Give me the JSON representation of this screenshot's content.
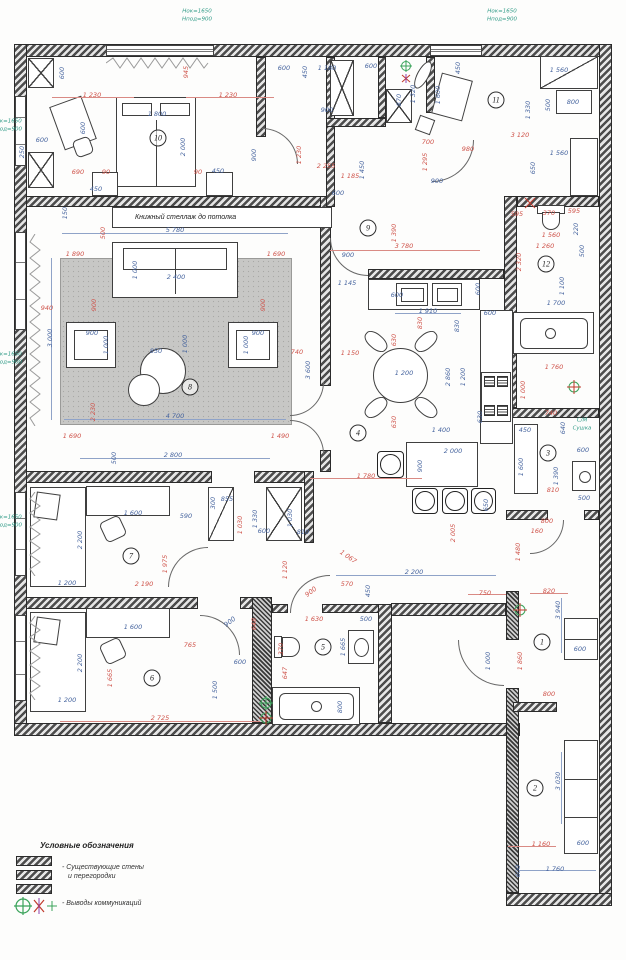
{
  "texts": {
    "bookshelf": "Книжный стеллаж до потолка",
    "laundry_1": "С/М",
    "laundry_2": "Сушка"
  },
  "legend": {
    "title": "Условные обозначения",
    "walls_label_1": "- Существующие стены",
    "walls_label_2": "и перегородки",
    "comm_label": "- Выводы коммуникаций"
  },
  "colors": {
    "dim_red": "#cf544b",
    "dim_blue": "#47659f",
    "annot_green": "#2f9a86",
    "wall": "#4c4c4c"
  },
  "rooms": [
    {
      "n": "10",
      "x": 158,
      "y": 138
    },
    {
      "n": "11",
      "x": 496,
      "y": 100
    },
    {
      "n": "9",
      "x": 368,
      "y": 228
    },
    {
      "n": "12",
      "x": 546,
      "y": 264
    },
    {
      "n": "8",
      "x": 190,
      "y": 387
    },
    {
      "n": "4",
      "x": 358,
      "y": 433
    },
    {
      "n": "3",
      "x": 548,
      "y": 453
    },
    {
      "n": "7",
      "x": 131,
      "y": 556
    },
    {
      "n": "5",
      "x": 323,
      "y": 647
    },
    {
      "n": "6",
      "x": 152,
      "y": 678
    },
    {
      "n": "1",
      "x": 542,
      "y": 642
    },
    {
      "n": "2",
      "x": 535,
      "y": 788
    }
  ],
  "dims": [
    {
      "t": "Hок=1650",
      "x": 197,
      "y": 12,
      "c": "g"
    },
    {
      "t": "Hпод=900",
      "x": 197,
      "y": 20,
      "c": "g"
    },
    {
      "t": "Hок=1650",
      "x": 502,
      "y": 12,
      "c": "g"
    },
    {
      "t": "Hпод=900",
      "x": 502,
      "y": 20,
      "c": "g"
    },
    {
      "t": "Hок=1650",
      "x": 7,
      "y": 122,
      "c": "g"
    },
    {
      "t": "Hпод=900",
      "x": 7,
      "y": 130,
      "c": "g"
    },
    {
      "t": "Hок=1650",
      "x": 7,
      "y": 355,
      "c": "g"
    },
    {
      "t": "Hпод=900",
      "x": 7,
      "y": 363,
      "c": "g"
    },
    {
      "t": "Hок=1650",
      "x": 7,
      "y": 518,
      "c": "g"
    },
    {
      "t": "Hпод=900",
      "x": 7,
      "y": 526,
      "c": "g"
    },
    {
      "t": "С/М",
      "x": 582,
      "y": 421,
      "c": "g"
    },
    {
      "t": "Сушка",
      "x": 582,
      "y": 429,
      "c": "g"
    },
    {
      "t": "1 230",
      "x": 92,
      "y": 95,
      "c": "r"
    },
    {
      "t": "1 230",
      "x": 228,
      "y": 95,
      "c": "r"
    },
    {
      "t": "1 800",
      "x": 157,
      "y": 114,
      "c": "b"
    },
    {
      "t": "2 000",
      "x": 183,
      "y": 147,
      "c": "b",
      "v": 1
    },
    {
      "t": "945",
      "x": 186,
      "y": 72,
      "c": "r",
      "v": 1
    },
    {
      "t": "600",
      "x": 62,
      "y": 73,
      "c": "b",
      "v": 1
    },
    {
      "t": "600",
      "x": 42,
      "y": 140,
      "c": "b"
    },
    {
      "t": "250",
      "x": 22,
      "y": 152,
      "c": "b",
      "v": 1
    },
    {
      "t": "600",
      "x": 83,
      "y": 128,
      "c": "b",
      "v": 1
    },
    {
      "t": "690",
      "x": 78,
      "y": 172,
      "c": "r"
    },
    {
      "t": "90",
      "x": 106,
      "y": 172,
      "c": "r"
    },
    {
      "t": "90",
      "x": 198,
      "y": 172,
      "c": "r"
    },
    {
      "t": "450",
      "x": 96,
      "y": 189,
      "c": "b"
    },
    {
      "t": "450",
      "x": 218,
      "y": 171,
      "c": "b"
    },
    {
      "t": "900",
      "x": 254,
      "y": 155,
      "c": "b",
      "v": 1
    },
    {
      "t": "1 230",
      "x": 299,
      "y": 155,
      "c": "r",
      "v": 1
    },
    {
      "t": "600",
      "x": 284,
      "y": 68,
      "c": "b"
    },
    {
      "t": "450",
      "x": 305,
      "y": 72,
      "c": "b",
      "v": 1
    },
    {
      "t": "1 180",
      "x": 327,
      "y": 68,
      "c": "b"
    },
    {
      "t": "600",
      "x": 371,
      "y": 66,
      "c": "b"
    },
    {
      "t": "450",
      "x": 458,
      "y": 68,
      "c": "b",
      "v": 1
    },
    {
      "t": "1 320",
      "x": 413,
      "y": 94,
      "c": "b",
      "v": 1
    },
    {
      "t": "870",
      "x": 399,
      "y": 100,
      "c": "b",
      "v": 1
    },
    {
      "t": "900",
      "x": 327,
      "y": 110,
      "c": "b"
    },
    {
      "t": "1 600",
      "x": 438,
      "y": 95,
      "c": "b",
      "v": 1
    },
    {
      "t": "1 330",
      "x": 528,
      "y": 110,
      "c": "b",
      "v": 1
    },
    {
      "t": "500",
      "x": 548,
      "y": 105,
      "c": "b",
      "v": 1
    },
    {
      "t": "800",
      "x": 573,
      "y": 102,
      "c": "b"
    },
    {
      "t": "1 560",
      "x": 559,
      "y": 70,
      "c": "b"
    },
    {
      "t": "3 120",
      "x": 520,
      "y": 135,
      "c": "r"
    },
    {
      "t": "980",
      "x": 468,
      "y": 149,
      "c": "r"
    },
    {
      "t": "700",
      "x": 428,
      "y": 142,
      "c": "r"
    },
    {
      "t": "900",
      "x": 437,
      "y": 181,
      "c": "b"
    },
    {
      "t": "1 560",
      "x": 559,
      "y": 153,
      "c": "b"
    },
    {
      "t": "650",
      "x": 533,
      "y": 168,
      "c": "b",
      "v": 1
    },
    {
      "t": "1 450",
      "x": 362,
      "y": 170,
      "c": "b",
      "v": 1
    },
    {
      "t": "1 295",
      "x": 425,
      "y": 162,
      "c": "r",
      "v": 1
    },
    {
      "t": "2 255",
      "x": 326,
      "y": 166,
      "c": "r"
    },
    {
      "t": "1 185",
      "x": 350,
      "y": 176,
      "c": "r"
    },
    {
      "t": "600",
      "x": 338,
      "y": 193,
      "c": "b"
    },
    {
      "t": "1 390",
      "x": 394,
      "y": 233,
      "c": "r",
      "v": 1
    },
    {
      "t": "595",
      "x": 517,
      "y": 214,
      "c": "r"
    },
    {
      "t": "370",
      "x": 549,
      "y": 213,
      "c": "r"
    },
    {
      "t": "595",
      "x": 574,
      "y": 211,
      "c": "r"
    },
    {
      "t": "220",
      "x": 576,
      "y": 229,
      "c": "b",
      "v": 1
    },
    {
      "t": "1 560",
      "x": 551,
      "y": 235,
      "c": "r"
    },
    {
      "t": "1 260",
      "x": 545,
      "y": 246,
      "c": "r"
    },
    {
      "t": "500",
      "x": 582,
      "y": 251,
      "c": "b",
      "v": 1
    },
    {
      "t": "2 320",
      "x": 519,
      "y": 262,
      "c": "r",
      "v": 1
    },
    {
      "t": "1 100",
      "x": 562,
      "y": 286,
      "c": "b",
      "v": 1
    },
    {
      "t": "1 700",
      "x": 556,
      "y": 303,
      "c": "b"
    },
    {
      "t": "1 760",
      "x": 554,
      "y": 367,
      "c": "r"
    },
    {
      "t": "1 000",
      "x": 523,
      "y": 390,
      "c": "r",
      "v": 1
    },
    {
      "t": "740",
      "x": 551,
      "y": 413,
      "c": "r"
    },
    {
      "t": "640",
      "x": 563,
      "y": 428,
      "c": "b",
      "v": 1
    },
    {
      "t": "450",
      "x": 525,
      "y": 430,
      "c": "b"
    },
    {
      "t": "600",
      "x": 583,
      "y": 450,
      "c": "b"
    },
    {
      "t": "1 600",
      "x": 521,
      "y": 467,
      "c": "b",
      "v": 1
    },
    {
      "t": "1 390",
      "x": 556,
      "y": 476,
      "c": "b",
      "v": 1
    },
    {
      "t": "810",
      "x": 553,
      "y": 490,
      "c": "r"
    },
    {
      "t": "500",
      "x": 584,
      "y": 498,
      "c": "b"
    },
    {
      "t": "800",
      "x": 547,
      "y": 521,
      "c": "r"
    },
    {
      "t": "160",
      "x": 537,
      "y": 531,
      "c": "r"
    },
    {
      "t": "1 480",
      "x": 518,
      "y": 552,
      "c": "r",
      "v": 1
    },
    {
      "t": "750",
      "x": 485,
      "y": 593,
      "c": "r"
    },
    {
      "t": "820",
      "x": 549,
      "y": 591,
      "c": "r"
    },
    {
      "t": "3 940",
      "x": 558,
      "y": 610,
      "c": "b",
      "v": 1
    },
    {
      "t": "600",
      "x": 580,
      "y": 649,
      "c": "b"
    },
    {
      "t": "1 000",
      "x": 488,
      "y": 661,
      "c": "b",
      "v": 1
    },
    {
      "t": "1 860",
      "x": 520,
      "y": 661,
      "c": "r",
      "v": 1
    },
    {
      "t": "800",
      "x": 549,
      "y": 694,
      "c": "r"
    },
    {
      "t": "1 160",
      "x": 541,
      "y": 844,
      "c": "r"
    },
    {
      "t": "600",
      "x": 583,
      "y": 843,
      "c": "b"
    },
    {
      "t": "3 030",
      "x": 558,
      "y": 781,
      "c": "b",
      "v": 1
    },
    {
      "t": "1 760",
      "x": 555,
      "y": 869,
      "c": "b"
    },
    {
      "t": "600",
      "x": 518,
      "y": 871,
      "c": "b",
      "v": 1
    },
    {
      "t": "3 780",
      "x": 404,
      "y": 246,
      "c": "r"
    },
    {
      "t": "900",
      "x": 348,
      "y": 255,
      "c": "b"
    },
    {
      "t": "1 145",
      "x": 347,
      "y": 283,
      "c": "b"
    },
    {
      "t": "600",
      "x": 397,
      "y": 295,
      "c": "b"
    },
    {
      "t": "1 910",
      "x": 428,
      "y": 311,
      "c": "b"
    },
    {
      "t": "600",
      "x": 478,
      "y": 289,
      "c": "b",
      "v": 1
    },
    {
      "t": "600",
      "x": 490,
      "y": 313,
      "c": "b"
    },
    {
      "t": "830",
      "x": 420,
      "y": 323,
      "c": "r",
      "v": 1
    },
    {
      "t": "830",
      "x": 457,
      "y": 326,
      "c": "b",
      "v": 1
    },
    {
      "t": "630",
      "x": 394,
      "y": 340,
      "c": "r",
      "v": 1
    },
    {
      "t": "1 150",
      "x": 350,
      "y": 353,
      "c": "r"
    },
    {
      "t": "1 200",
      "x": 404,
      "y": 373,
      "c": "b"
    },
    {
      "t": "2 860",
      "x": 448,
      "y": 377,
      "c": "b",
      "v": 1
    },
    {
      "t": "1 200",
      "x": 463,
      "y": 377,
      "c": "b",
      "v": 1
    },
    {
      "t": "630",
      "x": 394,
      "y": 422,
      "c": "r",
      "v": 1
    },
    {
      "t": "630",
      "x": 480,
      "y": 417,
      "c": "b",
      "v": 1
    },
    {
      "t": "1 400",
      "x": 441,
      "y": 430,
      "c": "b"
    },
    {
      "t": "2 000",
      "x": 453,
      "y": 451,
      "c": "b"
    },
    {
      "t": "900",
      "x": 420,
      "y": 466,
      "c": "b",
      "v": 1
    },
    {
      "t": "1 780",
      "x": 366,
      "y": 476,
      "c": "r"
    },
    {
      "t": "650",
      "x": 486,
      "y": 505,
      "c": "b",
      "v": 1
    },
    {
      "t": "2 005",
      "x": 453,
      "y": 533,
      "c": "r",
      "v": 1
    },
    {
      "t": "2 200",
      "x": 414,
      "y": 572,
      "c": "b"
    },
    {
      "t": "1 067",
      "x": 348,
      "y": 557,
      "c": "r",
      "rot": 35
    },
    {
      "t": "570",
      "x": 347,
      "y": 584,
      "c": "r"
    },
    {
      "t": "450",
      "x": 368,
      "y": 591,
      "c": "b",
      "v": 1
    },
    {
      "t": "900",
      "x": 311,
      "y": 592,
      "c": "r",
      "rot": -38
    },
    {
      "t": "900",
      "x": 230,
      "y": 622,
      "c": "b",
      "rot": -38
    },
    {
      "t": "1 630",
      "x": 314,
      "y": 619,
      "c": "r"
    },
    {
      "t": "500",
      "x": 366,
      "y": 619,
      "c": "b"
    },
    {
      "t": "1 665",
      "x": 343,
      "y": 647,
      "c": "b",
      "v": 1
    },
    {
      "t": "370",
      "x": 281,
      "y": 649,
      "c": "r",
      "v": 1
    },
    {
      "t": "647",
      "x": 285,
      "y": 673,
      "c": "r",
      "v": 1
    },
    {
      "t": "800",
      "x": 340,
      "y": 707,
      "c": "b",
      "v": 1
    },
    {
      "t": "648",
      "x": 254,
      "y": 624,
      "c": "r",
      "v": 1
    },
    {
      "t": "600",
      "x": 240,
      "y": 662,
      "c": "b"
    },
    {
      "t": "5 780",
      "x": 175,
      "y": 230,
      "c": "b"
    },
    {
      "t": "150",
      "x": 65,
      "y": 213,
      "c": "b",
      "v": 1
    },
    {
      "t": "500",
      "x": 103,
      "y": 233,
      "c": "r",
      "v": 1
    },
    {
      "t": "1 890",
      "x": 75,
      "y": 254,
      "c": "r"
    },
    {
      "t": "1 690",
      "x": 276,
      "y": 254,
      "c": "r"
    },
    {
      "t": "2 400",
      "x": 176,
      "y": 277,
      "c": "b"
    },
    {
      "t": "1 000",
      "x": 135,
      "y": 270,
      "c": "b",
      "v": 1
    },
    {
      "t": "940",
      "x": 47,
      "y": 308,
      "c": "r"
    },
    {
      "t": "3 000",
      "x": 50,
      "y": 338,
      "c": "b",
      "v": 1
    },
    {
      "t": "900",
      "x": 94,
      "y": 305,
      "c": "r",
      "v": 1
    },
    {
      "t": "900",
      "x": 263,
      "y": 305,
      "c": "r",
      "v": 1
    },
    {
      "t": "900",
      "x": 92,
      "y": 333,
      "c": "b"
    },
    {
      "t": "1 000",
      "x": 106,
      "y": 345,
      "c": "b",
      "v": 1
    },
    {
      "t": "900",
      "x": 258,
      "y": 333,
      "c": "b"
    },
    {
      "t": "1 000",
      "x": 246,
      "y": 345,
      "c": "b",
      "v": 1
    },
    {
      "t": "850",
      "x": 156,
      "y": 351,
      "c": "b"
    },
    {
      "t": "1 000",
      "x": 185,
      "y": 344,
      "c": "b",
      "v": 1
    },
    {
      "t": "4 700",
      "x": 175,
      "y": 416,
      "c": "b"
    },
    {
      "t": "2 230",
      "x": 93,
      "y": 412,
      "c": "r",
      "v": 1
    },
    {
      "t": "1 690",
      "x": 72,
      "y": 436,
      "c": "r"
    },
    {
      "t": "1 490",
      "x": 280,
      "y": 436,
      "c": "r"
    },
    {
      "t": "2 800",
      "x": 173,
      "y": 455,
      "c": "b"
    },
    {
      "t": "740",
      "x": 297,
      "y": 352,
      "c": "r"
    },
    {
      "t": "3 600",
      "x": 308,
      "y": 370,
      "c": "b",
      "v": 1
    },
    {
      "t": "500",
      "x": 114,
      "y": 458,
      "c": "b",
      "v": 1
    },
    {
      "t": "1 600",
      "x": 133,
      "y": 513,
      "c": "b"
    },
    {
      "t": "590",
      "x": 186,
      "y": 516,
      "c": "b"
    },
    {
      "t": "300",
      "x": 213,
      "y": 503,
      "c": "b",
      "v": 1
    },
    {
      "t": "855",
      "x": 227,
      "y": 499,
      "c": "b"
    },
    {
      "t": "1 030",
      "x": 240,
      "y": 525,
      "c": "r",
      "v": 1
    },
    {
      "t": "1 330",
      "x": 255,
      "y": 519,
      "c": "b",
      "v": 1
    },
    {
      "t": "600",
      "x": 264,
      "y": 531,
      "c": "b"
    },
    {
      "t": "810",
      "x": 303,
      "y": 532,
      "c": "b"
    },
    {
      "t": "1 030",
      "x": 290,
      "y": 518,
      "c": "b",
      "v": 1
    },
    {
      "t": "1 975",
      "x": 165,
      "y": 564,
      "c": "r",
      "v": 1
    },
    {
      "t": "2 190",
      "x": 144,
      "y": 584,
      "c": "r"
    },
    {
      "t": "1 200",
      "x": 67,
      "y": 583,
      "c": "b"
    },
    {
      "t": "2 200",
      "x": 80,
      "y": 540,
      "c": "b",
      "v": 1
    },
    {
      "t": "1 120",
      "x": 285,
      "y": 570,
      "c": "r",
      "v": 1
    },
    {
      "t": "765",
      "x": 190,
      "y": 645,
      "c": "r"
    },
    {
      "t": "1 600",
      "x": 133,
      "y": 627,
      "c": "b"
    },
    {
      "t": "2 200",
      "x": 80,
      "y": 663,
      "c": "b",
      "v": 1
    },
    {
      "t": "1 665",
      "x": 110,
      "y": 678,
      "c": "r",
      "v": 1
    },
    {
      "t": "1 500",
      "x": 215,
      "y": 690,
      "c": "b",
      "v": 1
    },
    {
      "t": "1 200",
      "x": 67,
      "y": 700,
      "c": "b"
    },
    {
      "t": "2 725",
      "x": 160,
      "y": 718,
      "c": "r"
    }
  ]
}
